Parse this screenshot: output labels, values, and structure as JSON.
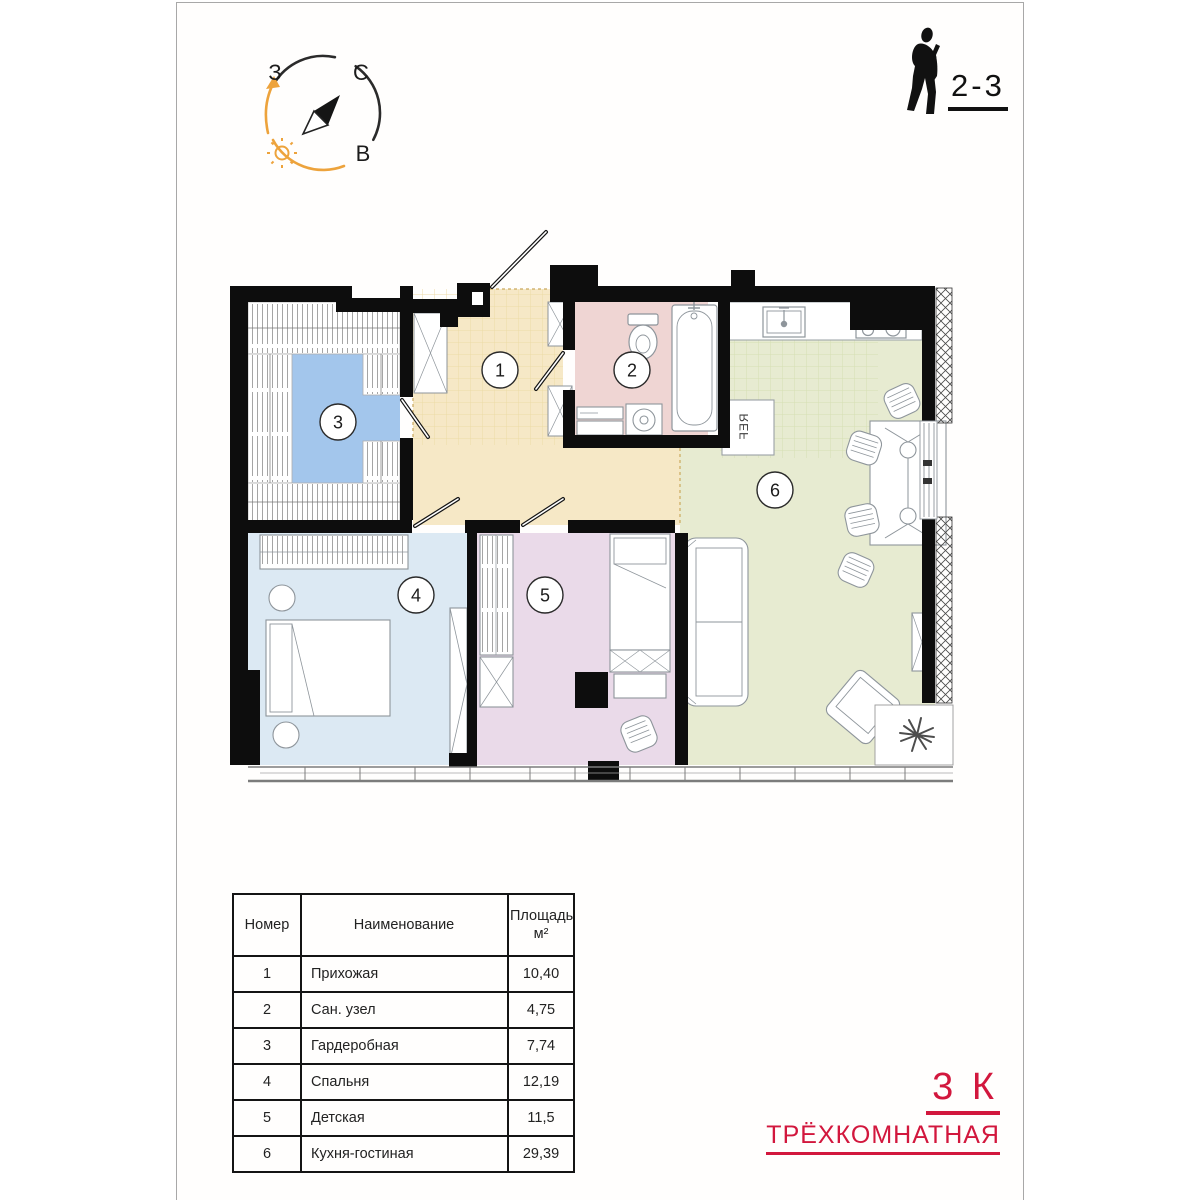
{
  "sheet": {
    "background": "#fffefd",
    "border_color": "#a8a8a8"
  },
  "compass": {
    "label_west": "З",
    "label_north": "С",
    "label_east": "В",
    "arc_color": "#2b2b2b",
    "accent_color": "#eda33c"
  },
  "unit_info": {
    "floors_label": "2-3"
  },
  "apartment": {
    "type_short": "3 К",
    "type_full": "ТРЁХКОМНАТНАЯ",
    "accent_color": "#d2173d"
  },
  "rooms_table": {
    "headers": {
      "number": "Номер",
      "name": "Наименование",
      "area_line1": "Площадь,",
      "area_line2": "м²"
    },
    "rows": [
      {
        "number": "1",
        "name": "Прихожая",
        "area": "10,40"
      },
      {
        "number": "2",
        "name": "Сан. узел",
        "area": "4,75"
      },
      {
        "number": "3",
        "name": "Гардеробная",
        "area": "7,74"
      },
      {
        "number": "4",
        "name": "Спальня",
        "area": "12,19"
      },
      {
        "number": "5",
        "name": "Детская",
        "area": "11,5"
      },
      {
        "number": "6",
        "name": "Кухня-гостиная",
        "area": "29,39"
      }
    ]
  },
  "floorplan": {
    "fridge_label": "REF",
    "wall_color": "#0d0d0d",
    "rooms": [
      {
        "number": "1",
        "name": "Прихожая",
        "color": "#f6e8c6"
      },
      {
        "number": "2",
        "name": "Сан. узел",
        "color": "#efd5d3"
      },
      {
        "number": "3",
        "name": "Гардеробная",
        "color": "#a3c6ec"
      },
      {
        "number": "4",
        "name": "Спальня",
        "color": "#dce9f3"
      },
      {
        "number": "5",
        "name": "Детская",
        "color": "#eadae9"
      },
      {
        "number": "6",
        "name": "Кухня-гостиная",
        "color": "#e7ebd1"
      }
    ]
  }
}
